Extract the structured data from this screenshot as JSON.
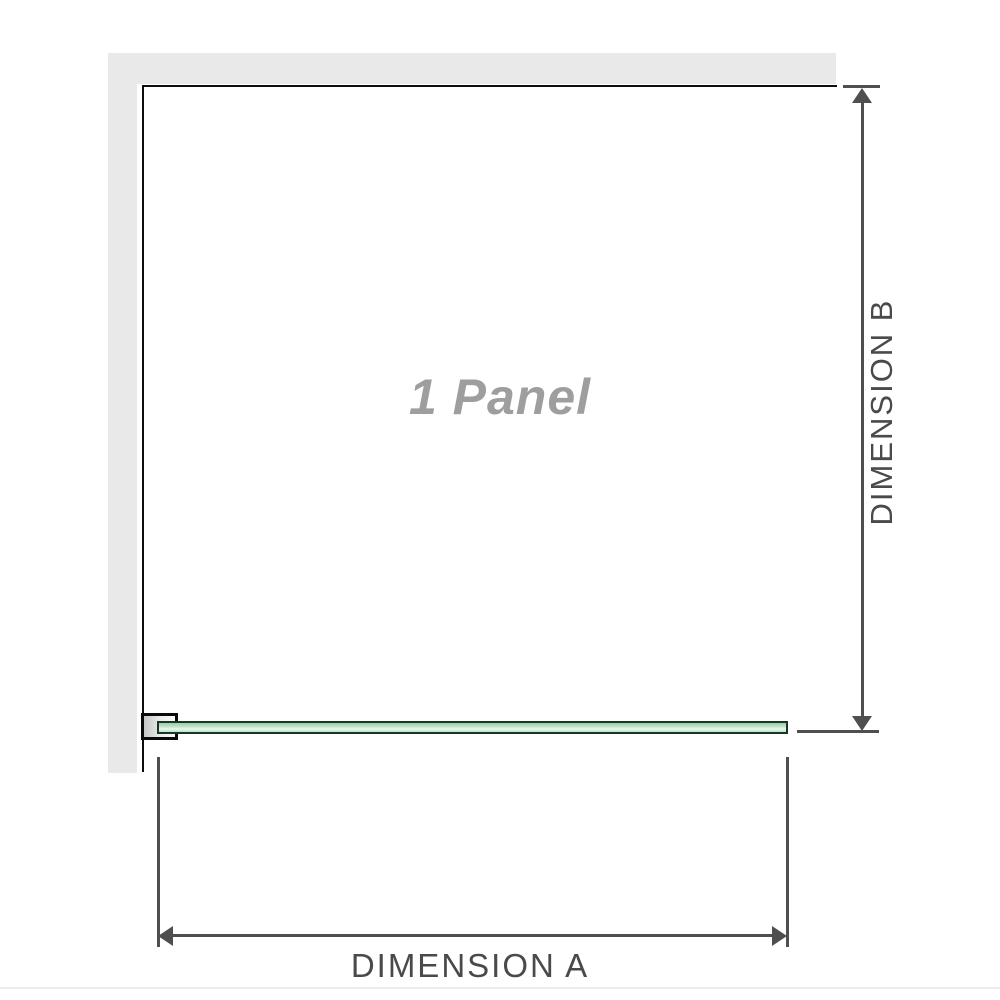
{
  "diagram": {
    "title": "1 Panel",
    "dimension_a_label": "DIMENSION A",
    "dimension_b_label": "DIMENSION B"
  },
  "colors": {
    "wall_gray": "#e9e9e9",
    "outline_black": "#0d0d0d",
    "dimension_gray": "#4f4f4f",
    "dimension_text": "#4a4a4a",
    "glass_border": "#1c3527",
    "glass_fill_dark": "#9ccfae",
    "glass_fill_mid": "#b7e0c3",
    "glass_fill_light": "#e9f7ec",
    "panel_label_gray": "#9e9e9e",
    "bracket_fill": "#c6c6c6",
    "bottom_edge": "#efeaea"
  }
}
